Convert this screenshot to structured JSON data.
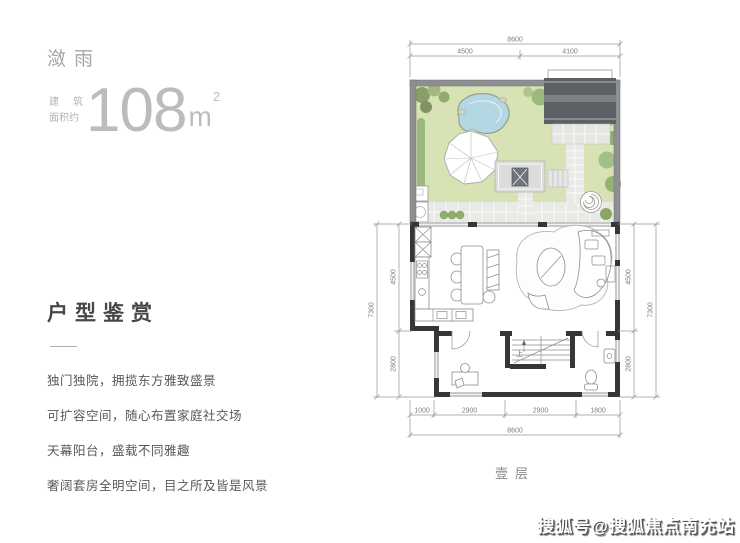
{
  "left_panel": {
    "title": "潋雨",
    "area_label_l1a": "建",
    "area_label_l1b": "筑",
    "area_label_l2": "面积约",
    "area_value": "108",
    "area_unit": "m",
    "area_sup": "2",
    "section_title": "户型鉴赏",
    "features": [
      "独门独院，拥揽东方雅致盛景",
      "可扩容空间，随心布置家庭社交场",
      "天幕阳台，盛载不同雅趣",
      "奢阔套房全明空间，目之所及皆是风景"
    ]
  },
  "plan": {
    "floor_label": "壹层",
    "stair_up_label": "上",
    "dims": {
      "top_total": "8600",
      "top_a": "4500",
      "top_b": "4100",
      "bottom_a": "1000",
      "bottom_b": "2900",
      "bottom_c": "2900",
      "bottom_d": "1800",
      "bottom_total": "8600",
      "left_a": "4500",
      "left_b": "2800",
      "left_total": "7300",
      "right_a": "4500",
      "right_b": "2800",
      "right_total": "7300"
    },
    "colors": {
      "lawn": "#d7e3b4",
      "pond": "#b3d7e3",
      "garden_wall": "#8d8f92",
      "roof": "#5d6165",
      "pavement": "#e9e9e6",
      "interior_wall": "#35363a"
    }
  },
  "watermark": "搜狐号@搜狐焦点南充站"
}
